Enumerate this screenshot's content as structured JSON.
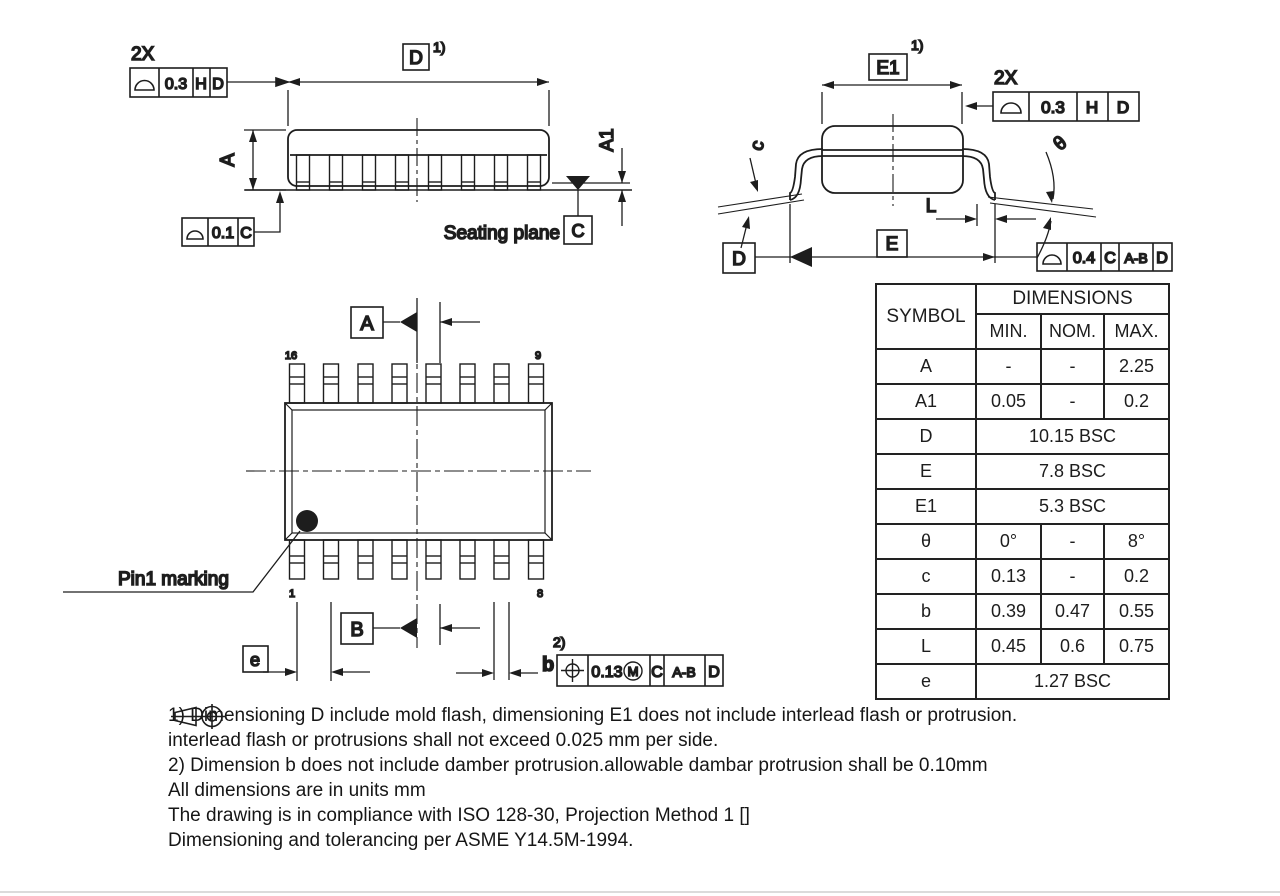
{
  "colors": {
    "ink": "#1d1d1d",
    "background": "#ffffff"
  },
  "side_view": {
    "qty": "2X",
    "fcf_top": {
      "tol": "0.3",
      "d1": "H",
      "d2": "D"
    },
    "dim_d": "D",
    "sup1": "1)",
    "dim_a": "A",
    "dim_a1": "A1",
    "fcf_seating": {
      "tol": "0.1",
      "d1": "C"
    },
    "seating_label": "Seating plane",
    "datum_c": "C"
  },
  "end_view": {
    "dim_e1": "E1",
    "sup1": "1)",
    "qty": "2X",
    "fcf_top": {
      "tol": "0.3",
      "d1": "H",
      "d2": "D"
    },
    "dim_c": "c",
    "dim_theta": "θ",
    "dim_l": "L",
    "dim_e": "E",
    "datum_d": "D",
    "fcf_bottom": {
      "tol": "0.4",
      "d1": "C",
      "d2": "A-B",
      "d3": "D"
    }
  },
  "top_view": {
    "datum_a": "A",
    "datum_b": "B",
    "pin16": "16",
    "pin9": "9",
    "pin1": "1",
    "pin8": "8",
    "pin1_label": "Pin1 marking",
    "dim_e": "e",
    "dim_b": "b",
    "sup2": "2)",
    "fcf_b": {
      "tol": "0.13",
      "mod": "M",
      "d1": "C",
      "d2": "A-B",
      "d3": "D"
    }
  },
  "table": {
    "symbol_header": "SYMBOL",
    "dimensions_header": "DIMENSIONS",
    "col_min": "MIN.",
    "col_nom": "NOM.",
    "col_max": "MAX.",
    "rows": [
      {
        "symbol": "A",
        "min": "-",
        "nom": "-",
        "max": "2.25"
      },
      {
        "symbol": "A1",
        "min": "0.05",
        "nom": "-",
        "max": "0.2"
      },
      {
        "symbol": "D",
        "span": "10.15 BSC"
      },
      {
        "symbol": "E",
        "span": "7.8 BSC"
      },
      {
        "symbol": "E1",
        "span": "5.3 BSC"
      },
      {
        "symbol": "θ",
        "min": "0°",
        "nom": "-",
        "max": "8°"
      },
      {
        "symbol": "c",
        "min": "0.13",
        "nom": "-",
        "max": "0.2"
      },
      {
        "symbol": "b",
        "min": "0.39",
        "nom": "0.47",
        "max": "0.55"
      },
      {
        "symbol": "L",
        "min": "0.45",
        "nom": "0.6",
        "max": "0.75"
      },
      {
        "symbol": "e",
        "span": "1.27 BSC"
      }
    ]
  },
  "notes": {
    "line1": "1) Dimensioning D include mold flash, dimensioning E1 does not include interlead flash or protrusion.",
    "line2": "interlead flash or protrusions shall not exceed 0.025 mm per side.",
    "line3": "2) Dimension b does not include damber protrusion.allowable dambar protrusion shall be 0.10mm",
    "line4": "All dimensions are in units mm",
    "line5_prefix": "The drawing is in compliance with ISO 128-30, Projection Method 1 [",
    "line5_suffix": "]",
    "line6": "Dimensioning and tolerancing per ASME Y14.5M-1994."
  }
}
